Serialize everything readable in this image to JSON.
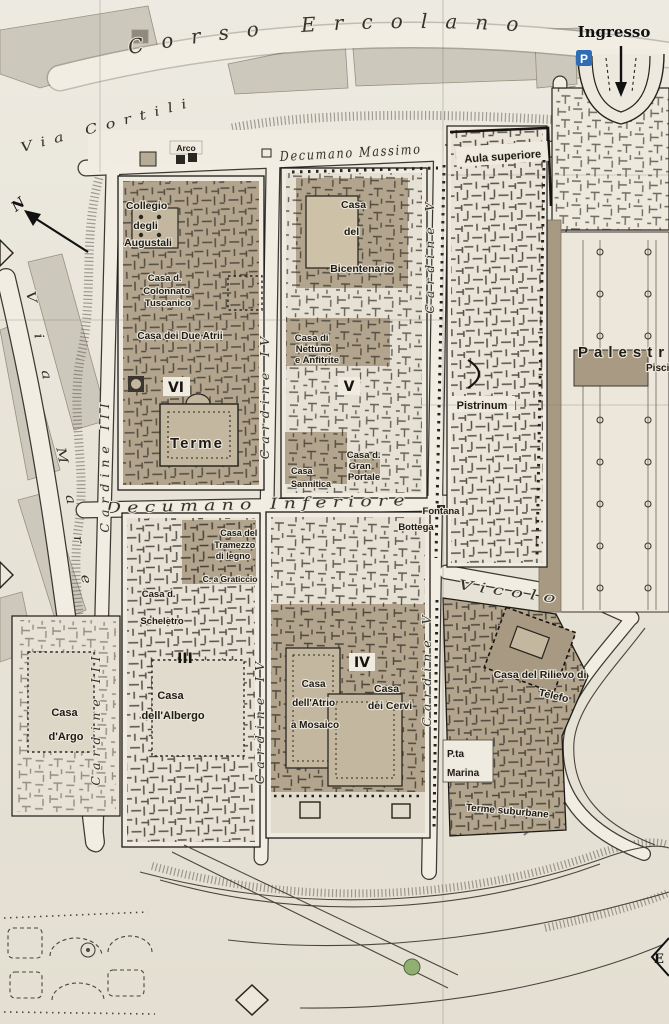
{
  "colors": {
    "paper": "#e8e4d9",
    "street_white": "#f1ede2",
    "building_tan": "#b3a58d",
    "building_tan_dark": "#a2947c",
    "building_gray": "#cdc8bc",
    "wall_ink": "#26231d",
    "parking_blue": "#2f6cb5",
    "lawn_green": "#8fb070"
  },
  "entrance": {
    "label": "Ingresso",
    "parking": "P"
  },
  "compass": {
    "north": "N"
  },
  "edge_marker": {
    "east": "E"
  },
  "streets": {
    "corso": "Corso Ercolano",
    "cortili": "Via Cortili",
    "mare": "Via Mare",
    "dec_massimo": "Decumano Massimo",
    "dec_inferiore": "Decumano Inferiore",
    "vicolo": "Vicolo",
    "cardine3": "Cardine III",
    "cardine4": "Cardine IV",
    "cardine5": "Cardine V"
  },
  "insulae": {
    "vi": "VI",
    "v": "V",
    "iii": "III",
    "iv": "IV"
  },
  "buildings": {
    "arco": {
      "label": "Arco"
    },
    "aula": {
      "label": "Aula superiore"
    },
    "collegio": {
      "lines": [
        "Collegio",
        "degli",
        "Augustali"
      ]
    },
    "bicentenario": {
      "lines": [
        "Casa",
        "del",
        "Bicentenario"
      ]
    },
    "colonnato": {
      "lines": [
        "Casa d.",
        "Colonnato",
        "Tuscanico"
      ]
    },
    "due_atrii": {
      "label": "Casa dei Due Atrii"
    },
    "nettuno": {
      "lines": [
        "Casa di",
        "Nettuno",
        "e Anfitrite"
      ]
    },
    "terme": {
      "label": "Terme"
    },
    "sannitica": {
      "lines": [
        "Casa",
        "Sannitica"
      ]
    },
    "gran_portale": {
      "lines": [
        "Casa d.",
        "Gran",
        "Portale"
      ]
    },
    "pistrinum": {
      "label": "Pistrinum"
    },
    "palestra": {
      "label": "Palestra"
    },
    "piscina": {
      "label": "Piscina"
    },
    "fontana": {
      "label": "Fontana"
    },
    "bottega": {
      "label": "Bottega"
    },
    "tramezzo": {
      "lines": [
        "Casa del",
        "Tramezzo",
        "di legno"
      ]
    },
    "graticcio": {
      "label": "C. a Graticcio"
    },
    "scheletro": {
      "lines": [
        "Casa d.",
        "Scheletro"
      ]
    },
    "albergo": {
      "lines": [
        "Casa",
        "dell'Albergo"
      ]
    },
    "argo": {
      "lines": [
        "Casa",
        "d'Argo"
      ]
    },
    "atrio_mosaico": {
      "lines": [
        "Casa",
        "dell'Atrio",
        "a Mosaico"
      ]
    },
    "cervi": {
      "lines": [
        "Casa",
        "dei Cervi"
      ]
    },
    "telefo": {
      "lines": [
        "Casa del Rilievo di",
        "Telefo"
      ]
    },
    "porta_marina": {
      "lines": [
        "P.ta",
        "Marina"
      ]
    },
    "terme_suburbane": {
      "label": "Terme suburbane"
    }
  }
}
